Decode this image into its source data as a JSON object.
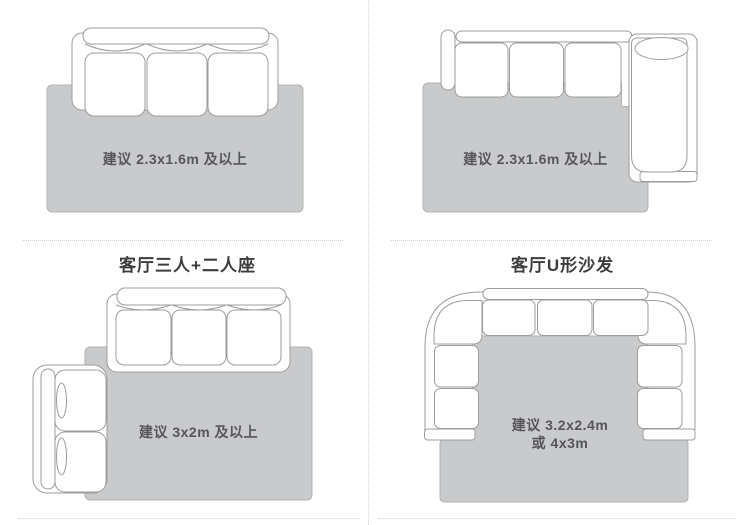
{
  "colors": {
    "background": "#ffffff",
    "rug_fill": "#c9cacc",
    "rug_border": "#b2b4b6",
    "sofa_outline": "#9b9c9e",
    "label_text": "#55565a",
    "title_text": "#3c3d3f",
    "divider": "#cfd4d7"
  },
  "quadrants": {
    "top_left": {
      "rug_label": "建议 2.3x1.6m 及以上"
    },
    "top_right": {
      "rug_label": "建议 2.3x1.6m 及以上"
    },
    "bottom_left": {
      "title": "客厅三人+二人座",
      "rug_label": "建议 3x2m 及以上"
    },
    "bottom_right": {
      "title": "客厅U形沙发",
      "rug_label_line1": "建议 3.2x2.4m",
      "rug_label_line2": "或 4x3m"
    }
  }
}
